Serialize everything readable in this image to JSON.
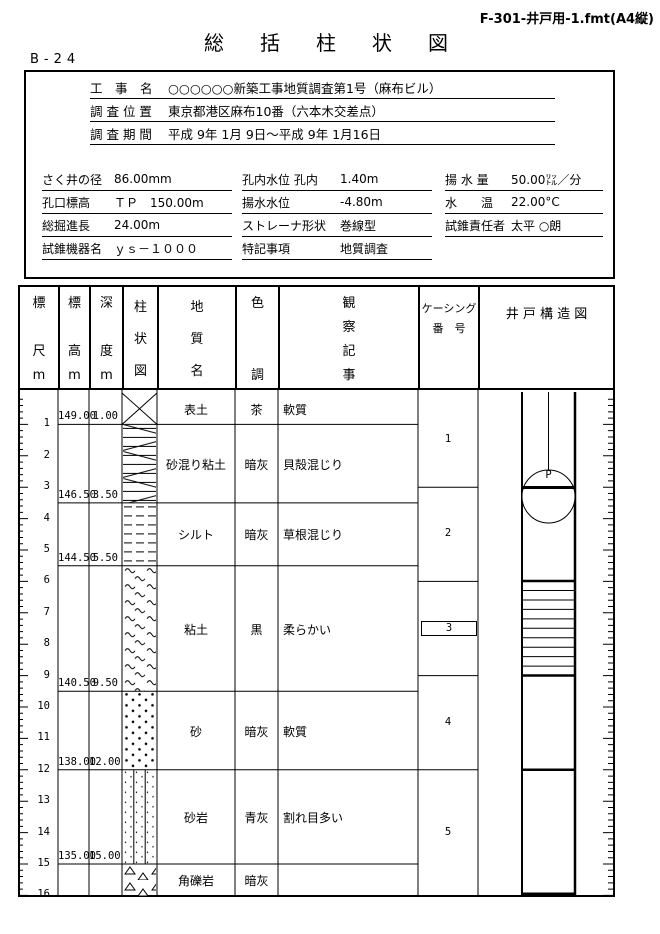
{
  "page": {
    "format_label": "F-301-井戸用-1.fmt(A4縦)",
    "title": "総　括　柱　状　図",
    "boring_id": "B-24"
  },
  "project": {
    "rows": [
      {
        "label": "工　事　名",
        "value": "○○○○○○新築工事地質調査第1号（麻布ビル）"
      },
      {
        "label": "調 査 位 置",
        "value": "東京都港区麻布10番（六本木交差点）"
      },
      {
        "label": "調 査 期 間",
        "value": "平成 9年 1月 9日～平成 9年 1月16日"
      }
    ]
  },
  "specs": {
    "col1": [
      {
        "label": "さく井の径",
        "value": "86.00mm"
      },
      {
        "label": "孔口標高",
        "value": "ＴＰ　150.00m"
      },
      {
        "label": "総掘進長",
        "value": "24.00m"
      },
      {
        "label": "試錐機器名",
        "value": "ｙｓ－１０００"
      }
    ],
    "col2": [
      {
        "label": "孔内水位 孔内",
        "value": "1.40m"
      },
      {
        "label": "揚水水位",
        "value": "-4.80m"
      },
      {
        "label": "ストレーナ形状",
        "value": "巻線型"
      },
      {
        "label": "特記事項",
        "value": "地質調査"
      }
    ],
    "col3": [
      {
        "label": "揚 水 量",
        "value": "50.00㍑／分"
      },
      {
        "label": "水　　温",
        "value": "22.00°C"
      },
      {
        "label": "試錐責任者",
        "value": "太平 ○朗"
      }
    ]
  },
  "table": {
    "headers": [
      "標\n\n尺\nm",
      "標\n\n高\nm",
      "深\n\n度\nm",
      "柱\n状\n図",
      "地\n質\n名",
      "色\n\n\n調",
      "観\n察\n記\n事",
      "ケーシング\n番　号",
      "井 戸 構 造 図"
    ],
    "scale": {
      "meters_per_major_tick": 1,
      "meters_per_minor_tick": 0.2,
      "labels": [
        "1",
        "2",
        "3",
        "4",
        "5",
        "6",
        "7",
        "8",
        "9",
        "10",
        "11",
        "12",
        "13",
        "14",
        "15",
        "16"
      ]
    },
    "layers": [
      {
        "name": "表土",
        "color": "茶",
        "observation": "軟質",
        "from": 0,
        "to": 1.0,
        "elevation_base": "149.00",
        "depth_base": "1.00",
        "pattern": "topsoil"
      },
      {
        "name": "砂混り粘土",
        "color": "暗灰",
        "observation": "貝殻混じり",
        "from": 1.0,
        "to": 3.5,
        "elevation_base": "146.50",
        "depth_base": "3.50",
        "pattern": "sandy-clay"
      },
      {
        "name": "シルト",
        "color": "暗灰",
        "observation": "草根混じり",
        "from": 3.5,
        "to": 5.5,
        "elevation_base": "144.50",
        "depth_base": "5.50",
        "pattern": "silt"
      },
      {
        "name": "粘土",
        "color": "黒",
        "observation": "柔らかい",
        "from": 5.5,
        "to": 9.5,
        "elevation_base": "140.50",
        "depth_base": "9.50",
        "pattern": "clay"
      },
      {
        "name": "砂",
        "color": "暗灰",
        "observation": "軟質",
        "from": 9.5,
        "to": 12.0,
        "elevation_base": "138.00",
        "depth_base": "12.00",
        "pattern": "sand"
      },
      {
        "name": "砂岩",
        "color": "青灰",
        "observation": "割れ目多い",
        "from": 12.0,
        "to": 15.0,
        "elevation_base": "135.00",
        "depth_base": "15.00",
        "pattern": "sandstone"
      },
      {
        "name": "角礫岩",
        "color": "暗灰",
        "observation": "",
        "from": 15.0,
        "to": 16.05,
        "pattern": "breccia"
      }
    ],
    "casing": [
      {
        "label": "1",
        "from": 0,
        "to": 3,
        "boxed": false
      },
      {
        "label": "2",
        "from": 3,
        "to": 6,
        "boxed": false
      },
      {
        "label": "3",
        "from": 6,
        "to": 9,
        "boxed": true
      },
      {
        "label": "4",
        "from": 9,
        "to": 12,
        "boxed": false
      },
      {
        "label": "5",
        "from": 12,
        "to": 16.05,
        "boxed": false
      }
    ],
    "well": {
      "pump_label": "P"
    }
  }
}
